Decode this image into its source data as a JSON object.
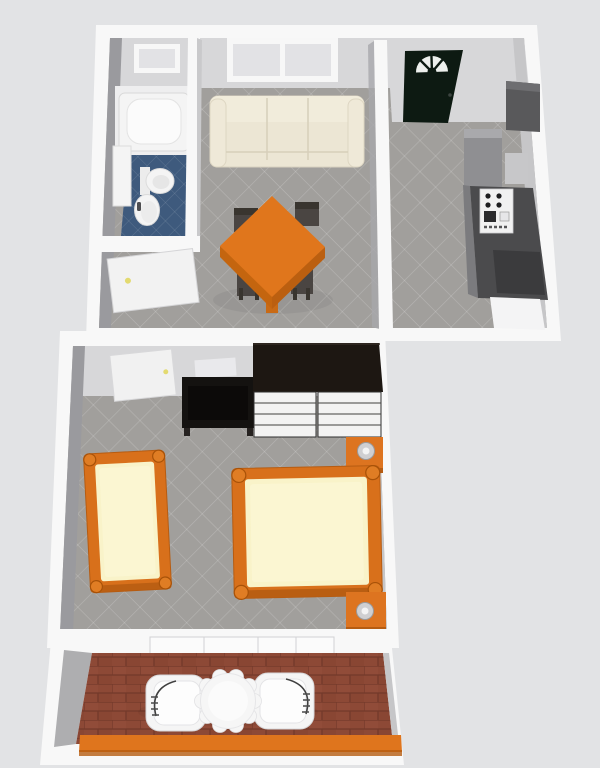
{
  "meta": {
    "kind": "3d-floor-plan-render",
    "view": "top-down perspective",
    "description": "Rendered top-down 3D floor plan of a one-bedroom apartment with balcony"
  },
  "rooms": [
    {
      "id": "bathroom",
      "name": "Bathroom",
      "floor": "blue tile",
      "items": [
        "bathtub",
        "toilet",
        "pedestal sink",
        "vanity counter",
        "small window",
        "open white door"
      ]
    },
    {
      "id": "living-dining",
      "name": "Living / Dining Room",
      "floor": "gray tile",
      "items": [
        "double window",
        "cream three-seat sofa",
        "orange square dining table",
        "four dark chairs"
      ]
    },
    {
      "id": "kitchen-entry",
      "name": "Kitchen / Entry Hall",
      "floor": "gray tile",
      "items": [
        "dark entry door with white fanlight",
        "tall cabinet",
        "refrigerator unit",
        "stove with burners",
        "dark counters",
        "white appliance"
      ]
    },
    {
      "id": "bedroom",
      "name": "Bedroom",
      "floor": "gray tile",
      "items": [
        "open white door",
        "black desk",
        "dark wardrobe",
        "two white dressers",
        "single bed",
        "double bed",
        "two orange nightstands with lamps"
      ]
    },
    {
      "id": "balcony",
      "name": "Balcony / Patio",
      "floor": "red brick",
      "items": [
        "sliding-door frames",
        "two white armchairs",
        "round scalloped white table",
        "orange railing"
      ]
    }
  ],
  "colors": {
    "background": "#e2e3e5",
    "wall_white": "#f8f8f8",
    "wall_face_light": "#d7d7d9",
    "wall_face_mid": "#c6c6c8",
    "wall_face_dark": "#9a9a9e",
    "floor_gray": "#a19f9c",
    "bath_floor_white": "#eeeeef",
    "bathroom_tile_blue": "#3e5a7d",
    "fixture_white": "#f4f4f4",
    "sofa_cream": "#ece6d4",
    "sofa_cream_light": "#f1ecdb",
    "window_pane": "#e2e2e5",
    "table_orange": "#e0761c",
    "table_orange_dark": "#bb5f10",
    "chair_dark": "#4a4542",
    "entry_door_dark": "#0d1a12",
    "fanlight_white": "#edf0ed",
    "kitchen_dark": "#4b4b4d",
    "kitchen_mid": "#8f8f92",
    "kitchen_light": "#c7c7c9",
    "kitchen_cabinet": "#59595b",
    "wardrobe_dark": "#1d1712",
    "desk_black": "#141210",
    "dresser_white": "#f3f3f3",
    "bed_frame_orange": "#d8701b",
    "bed_knob_orange": "#e07d24",
    "mattress_cream": "#f9f3c9",
    "nightstand_orange": "#dd7420",
    "lamp_gray": "#cfcfd1",
    "knob_yellow": "#e3da70",
    "brick_red": "#8d4936",
    "brick_grout": "#73392a",
    "rail_orange": "#df751d",
    "patio_furniture_white": "#f5f5f5"
  }
}
